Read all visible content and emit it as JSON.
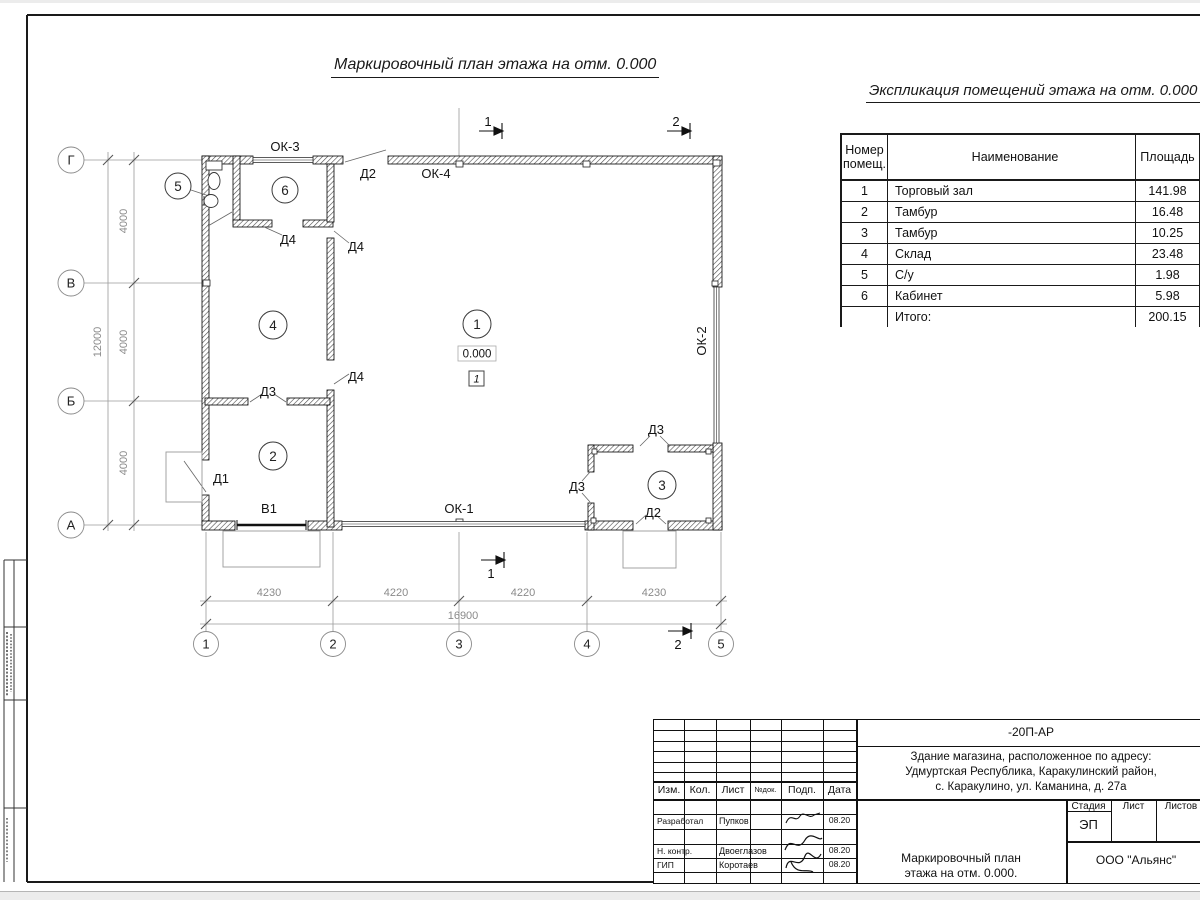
{
  "page": {
    "plan_title": "Маркировочный план этажа на отм. 0.000",
    "table_title": "Экспликация помещений этажа на отм. 0.000"
  },
  "explication": {
    "header": {
      "num_l1": "Номер",
      "num_l2": "помещ.",
      "name": "Наименование",
      "area": "Площадь",
      "cut_l1": "Ка",
      "cut_l2": "по"
    },
    "rows": [
      {
        "num": "1",
        "name": "Торговый зал",
        "area": "141.98"
      },
      {
        "num": "2",
        "name": "Тамбур",
        "area": "16.48"
      },
      {
        "num": "3",
        "name": "Тамбур",
        "area": "10.25"
      },
      {
        "num": "4",
        "name": "Склад",
        "area": "23.48"
      },
      {
        "num": "5",
        "name": "С/у",
        "area": "1.98"
      },
      {
        "num": "6",
        "name": "Кабинет",
        "area": "5.98"
      }
    ],
    "total": {
      "label": "Итого:",
      "area": "200.15"
    }
  },
  "plan": {
    "axis_letters": [
      "Г",
      "В",
      "Б",
      "А"
    ],
    "axis_numbers": [
      "1",
      "2",
      "3",
      "4",
      "5"
    ],
    "dims_bottom": [
      "4230",
      "4220",
      "4220",
      "4230"
    ],
    "dim_bottom_total": "16900",
    "dims_left": [
      "4000",
      "4000",
      "4000"
    ],
    "dim_left_total": "12000",
    "room_numbers": [
      "1",
      "2",
      "3",
      "4",
      "5",
      "6"
    ],
    "labels": {
      "ok1": "ОК-1",
      "ok2": "ОК-2",
      "ok3": "ОК-3",
      "ok4": "ОК-4",
      "d1": "Д1",
      "d2_top": "Д2",
      "d2_r3": "Д2",
      "d3_r2": "Д3",
      "d3_r3_left": "Д3",
      "d3_r3_top": "Д3",
      "d4_a": "Д4",
      "d4_b": "Д4",
      "d4_c": "Д4",
      "v1": "В1"
    },
    "level_mark": "0.000",
    "floor_type_mark": "1",
    "section_marks": {
      "s1": "1",
      "s2": "2"
    }
  },
  "titleblock": {
    "doc_code": "-20П-АР",
    "address_l1": "Здание магазина, расположенное по адресу:",
    "address_l2": "Удмуртская Республика, Каракулинский район,",
    "address_l3": "с. Каракулино, ул. Каманина, д. 27а",
    "col_izm": "Изм.",
    "col_kol": "Кол.",
    "col_list": "Лист",
    "col_ndok": "№док.",
    "col_podp": "Подп.",
    "col_data": "Дата",
    "row_developed": {
      "role": "Разработал",
      "name": "Пупков",
      "date": "08.20"
    },
    "row_ncontr": {
      "role": "Н. контр.",
      "name": "Двоеглазов",
      "date": "08.20"
    },
    "row_gip": {
      "role": "ГИП",
      "name": "Коротаев",
      "date": "08.20"
    },
    "stage_label": "Стадия",
    "list_label": "Лист",
    "listov_label": "Листов",
    "stage_value": "ЭП",
    "drawing_name_l1": "Маркировочный план",
    "drawing_name_l2": "этажа на отм. 0.000.",
    "company": "ООО \"Альянс\""
  }
}
